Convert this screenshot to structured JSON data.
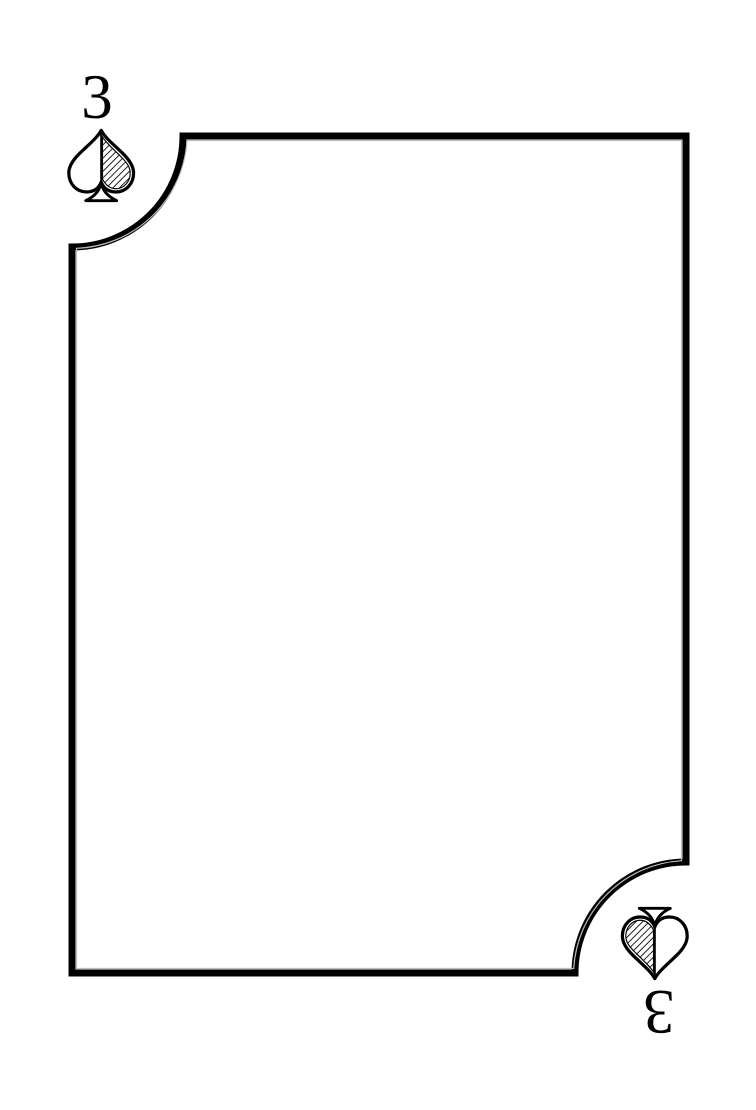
{
  "page": {
    "background_color": "#ffffff"
  },
  "card": {
    "name": "3 of spades",
    "rank": "3",
    "suit": "spades",
    "ink_color": "#000000",
    "face_color": "#ffffff",
    "inner_line_color": "#bdbdbd",
    "indices": {
      "top_left": {
        "rank": "3",
        "suit_icon": "spade"
      },
      "bottom_right": {
        "rank": "3",
        "suit_icon": "spade"
      }
    }
  }
}
